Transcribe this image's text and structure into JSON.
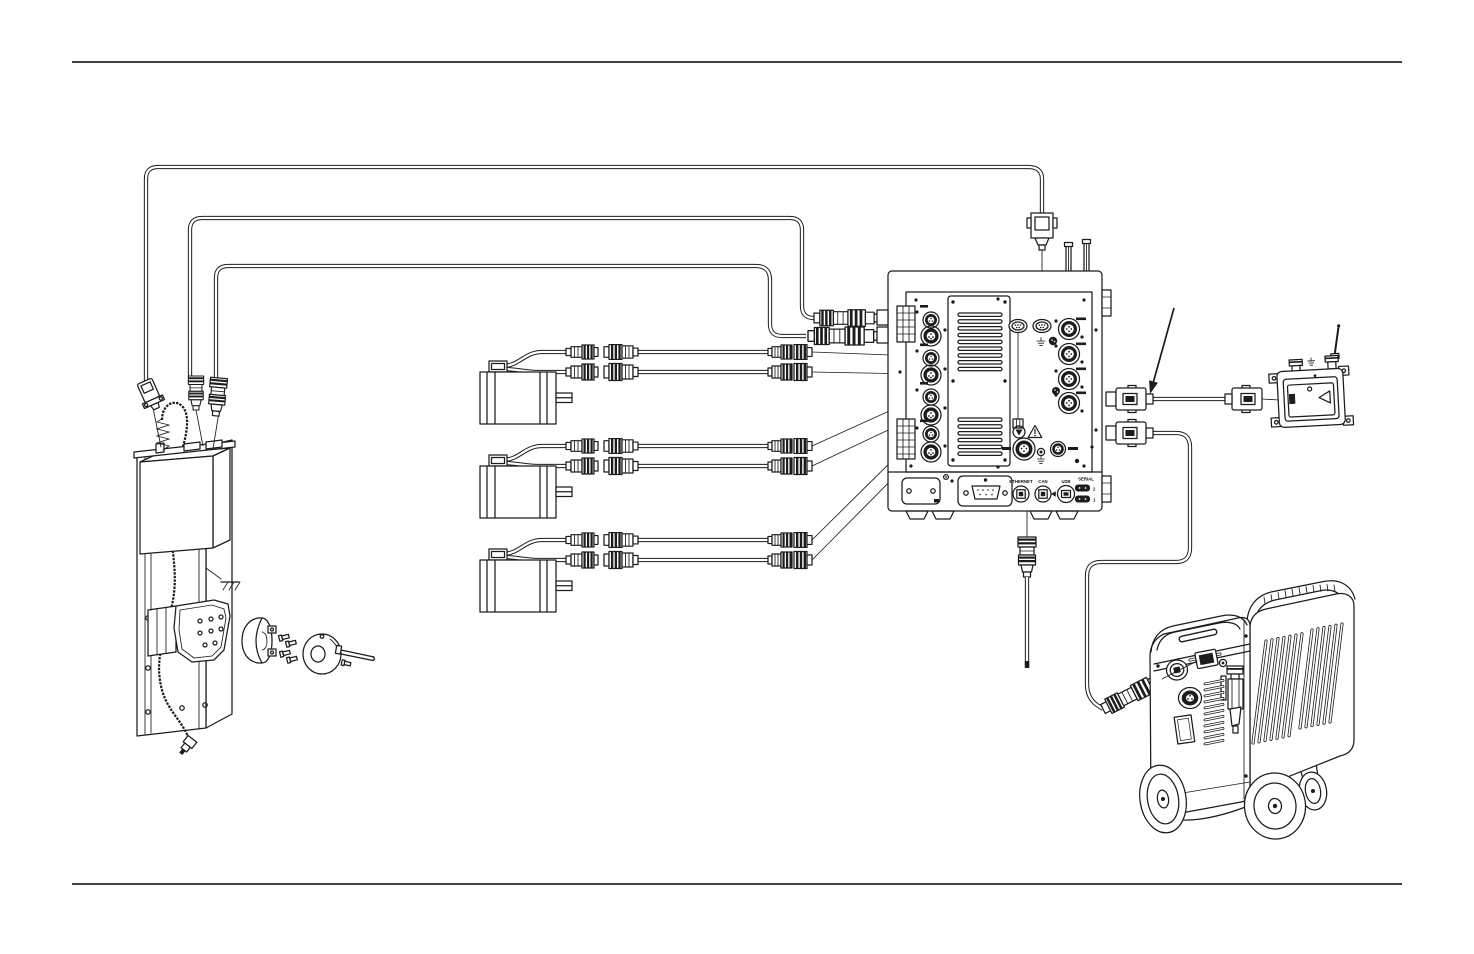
{
  "page": {
    "background": "#ffffff",
    "line_color": "#1c1c1c"
  },
  "controller": {
    "rear_ports": {
      "ethernet": "ETHERNET",
      "can": "CAN",
      "usb": "USB",
      "serial": "SERIAL",
      "serial_port_top": "2",
      "serial_port_bottom": "1"
    }
  },
  "icons": {
    "earth_ground": "⏚",
    "warning": "⚠",
    "usb_arrow": "◀",
    "annotation_arrow": "↘"
  }
}
